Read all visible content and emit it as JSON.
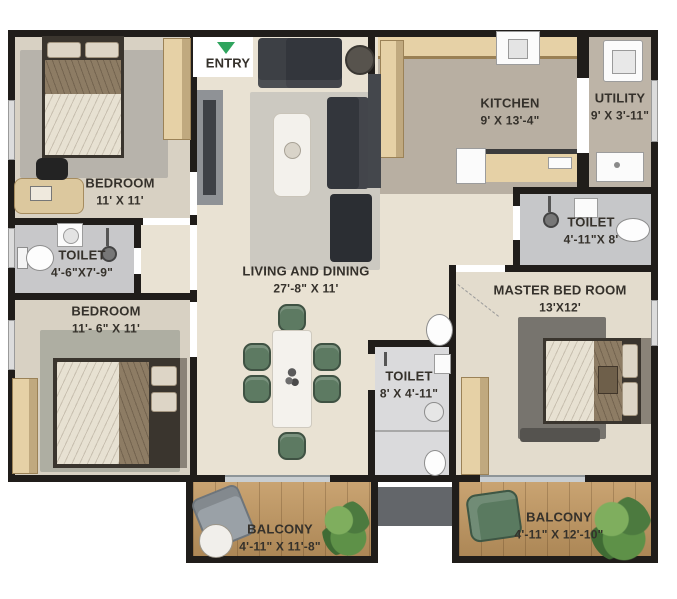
{
  "entry": {
    "label": "ENTRY"
  },
  "rooms": {
    "bedroom1": {
      "name": "BEDROOM",
      "dims": "11' X 11'"
    },
    "toilet1": {
      "name": "TOILET",
      "dims": "4'-6\"X7'-9\""
    },
    "bedroom2": {
      "name": "BEDROOM",
      "dims": "11'- 6\" X 11'"
    },
    "living": {
      "name": "LIVING AND DINING",
      "dims": "27'-8\" X 11'"
    },
    "kitchen": {
      "name": "KITCHEN",
      "dims": "9' X 13'-4\""
    },
    "utility": {
      "name": "UTILITY",
      "dims": "9' X 3'-11\""
    },
    "toilet2": {
      "name": "TOILET",
      "dims": "4'-11\"X 8'"
    },
    "master_bedroom": {
      "name": "MASTER BED ROOM",
      "dims": "13'X12'"
    },
    "toilet3": {
      "name": "TOILET",
      "dims": "8' X 4'-11\""
    },
    "balcony1": {
      "name": "BALCONY",
      "dims": "4'-11\" X 11'-8\""
    },
    "balcony2": {
      "name": "BALCONY",
      "dims": "4'-11\" X 12'-10\""
    }
  },
  "colors": {
    "wall": "#201d1a",
    "floor_main": "#e9e2d3",
    "floor_kitchen": "#b8afa2",
    "floor_toilet": "#c8c8ca",
    "floor_wood": "#c59c66",
    "cabinet_tan": "#e6d1a6",
    "sofa_charcoal": "#33363c",
    "dining_chair_green": "#5d7a62",
    "entry_arrow_green": "#2fa45e",
    "label_text": "#35312b"
  }
}
